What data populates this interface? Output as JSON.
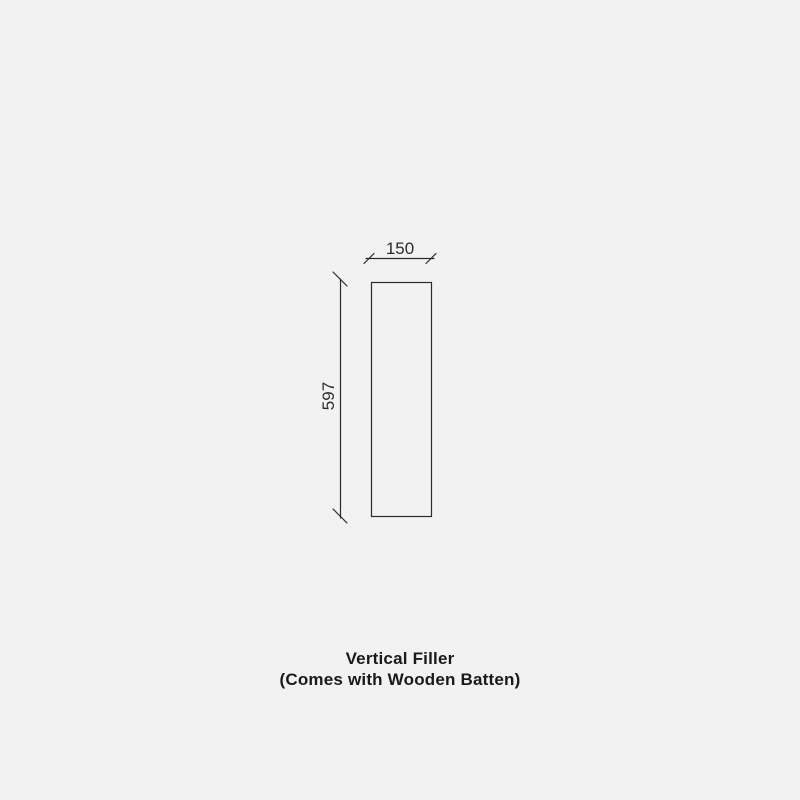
{
  "page": {
    "background_color": "#f2f2f2",
    "line_color": "#2b2b2b",
    "text_color": "#1a1a1a"
  },
  "drawing": {
    "type": "technical-dimension-drawing",
    "shape": "tall-rectangle-panel",
    "width_dimension": "150",
    "height_dimension": "597"
  },
  "caption": {
    "line1": "Vertical Filler",
    "line2": "(Comes with Wooden Batten)"
  }
}
